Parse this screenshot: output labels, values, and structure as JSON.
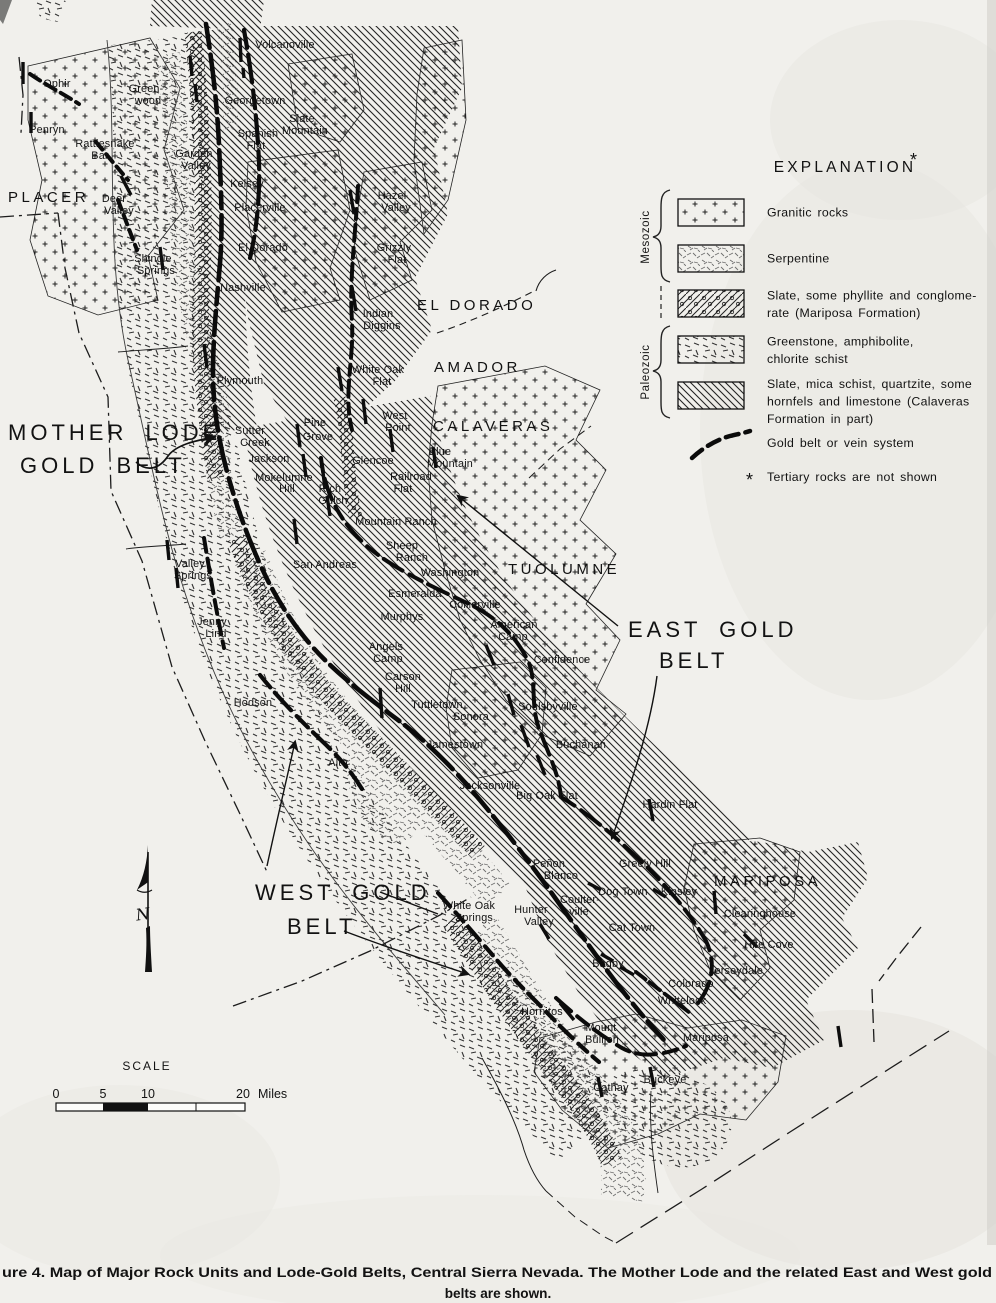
{
  "figure": {
    "caption_line1": "ure 4.  Map of Major Rock Units and Lode-Gold Belts, Central Sierra Nevada.  The Mother Lode and the related East and West gold",
    "caption_line2": "belts are shown."
  },
  "legend": {
    "title": "EXPLANATION",
    "asterisk": "*",
    "eras": [
      {
        "label": "Mesozoic"
      },
      {
        "label": "Paleozoic"
      }
    ],
    "items": [
      {
        "pattern": "granitic",
        "lines": [
          "Granitic rocks"
        ]
      },
      {
        "pattern": "serp",
        "lines": [
          "Serpentine"
        ]
      },
      {
        "pattern": "marip",
        "lines": [
          "Slate, some phyllite and conglome-",
          "rate (Mariposa Formation)"
        ]
      },
      {
        "pattern": "green",
        "lines": [
          "Greenstone, amphibolite,",
          "chlorite schist"
        ]
      },
      {
        "pattern": "cala",
        "lines": [
          "Slate, mica schist, quartzite, some",
          "hornfels and limestone (Calaveras",
          "Formation in part)"
        ]
      }
    ],
    "gold_line_label": "Gold belt or vein system",
    "footnote_marker": "*",
    "footnote": "Tertiary rocks are not shown"
  },
  "scale_bar": {
    "title": "SCALE",
    "tick_labels": [
      "0",
      "5",
      "10",
      "20"
    ],
    "unit": "Miles"
  },
  "compass": {
    "letter": "N"
  },
  "ink_color": "#141414",
  "paper_color": "#f1f0ec",
  "belt_annotations": [
    {
      "id": "mother-lode-gold-belt",
      "lines": [
        {
          "t": "MOTHER LODE",
          "x": 8,
          "y": 440
        },
        {
          "t": "GOLD BELT",
          "x": 20,
          "y": 473
        }
      ]
    },
    {
      "id": "east-gold-belt",
      "lines": [
        {
          "t": "EAST GOLD",
          "x": 628,
          "y": 637
        },
        {
          "t": "BELT",
          "x": 659,
          "y": 668
        }
      ]
    },
    {
      "id": "west-gold-belt",
      "lines": [
        {
          "t": "WEST GOLD",
          "x": 255,
          "y": 900
        },
        {
          "t": "BELT",
          "x": 287,
          "y": 934
        }
      ]
    }
  ],
  "counties": [
    {
      "t": "PLACER",
      "x": 8,
      "y": 202
    },
    {
      "t": "EL DORADO",
      "x": 417,
      "y": 310
    },
    {
      "t": "AMADOR",
      "x": 434,
      "y": 372
    },
    {
      "t": "CALAVERAS",
      "x": 433,
      "y": 431
    },
    {
      "t": "TUOLUMNE",
      "x": 508,
      "y": 574
    },
    {
      "t": "MARIPOSA",
      "x": 714,
      "y": 886
    }
  ],
  "towns": [
    {
      "t": "Volcanoville",
      "x": 285,
      "y": 48
    },
    {
      "t": "Ophir",
      "x": 57,
      "y": 87
    },
    {
      "t": "Penryn",
      "x": 47,
      "y": 133
    },
    {
      "t": "Green-",
      "x": 146,
      "y": 92
    },
    {
      "t": "wood",
      "x": 148,
      "y": 104
    },
    {
      "t": "Georgetown",
      "x": 255,
      "y": 104
    },
    {
      "t": "Slate",
      "x": 302,
      "y": 122
    },
    {
      "t": "Mountain",
      "x": 305,
      "y": 134
    },
    {
      "t": "Spanish",
      "x": 258,
      "y": 137
    },
    {
      "t": "Flat",
      "x": 256,
      "y": 149
    },
    {
      "t": "Rattlesnake",
      "x": 105,
      "y": 147
    },
    {
      "t": "Bar",
      "x": 100,
      "y": 159
    },
    {
      "t": "Garden",
      "x": 194,
      "y": 157
    },
    {
      "t": "Valley",
      "x": 196,
      "y": 169
    },
    {
      "t": "Kelsey",
      "x": 247,
      "y": 187
    },
    {
      "t": "Deer",
      "x": 114,
      "y": 202
    },
    {
      "t": "Valley",
      "x": 119,
      "y": 214
    },
    {
      "t": "Placerville",
      "x": 260,
      "y": 211
    },
    {
      "t": "El Dorado",
      "x": 263,
      "y": 251
    },
    {
      "t": "Shingle",
      "x": 153,
      "y": 262
    },
    {
      "t": "Springs",
      "x": 156,
      "y": 274
    },
    {
      "t": "Nashville",
      "x": 243,
      "y": 291
    },
    {
      "t": "Hazel",
      "x": 392,
      "y": 199
    },
    {
      "t": "Valley",
      "x": 396,
      "y": 211
    },
    {
      "t": "Grizzly",
      "x": 394,
      "y": 251
    },
    {
      "t": "Flat",
      "x": 397,
      "y": 263
    },
    {
      "t": "Indian",
      "x": 378,
      "y": 317
    },
    {
      "t": "Diggins",
      "x": 382,
      "y": 329
    },
    {
      "t": "White Oak",
      "x": 378,
      "y": 373
    },
    {
      "t": "Flat",
      "x": 382,
      "y": 385
    },
    {
      "t": "Plymouth",
      "x": 240,
      "y": 384
    },
    {
      "t": "Sutter",
      "x": 250,
      "y": 434
    },
    {
      "t": "Creek",
      "x": 255,
      "y": 446
    },
    {
      "t": "Pine",
      "x": 315,
      "y": 426
    },
    {
      "t": "Grove",
      "x": 318,
      "y": 440
    },
    {
      "t": "Jackson",
      "x": 269,
      "y": 462
    },
    {
      "t": "Mokelumne",
      "x": 284,
      "y": 481
    },
    {
      "t": "Hill",
      "x": 287,
      "y": 492
    },
    {
      "t": "Rich",
      "x": 330,
      "y": 492
    },
    {
      "t": "Gulch",
      "x": 333,
      "y": 504
    },
    {
      "t": "West",
      "x": 395,
      "y": 419
    },
    {
      "t": "Point",
      "x": 398,
      "y": 431
    },
    {
      "t": "Glencoe",
      "x": 373,
      "y": 464
    },
    {
      "t": "Blue",
      "x": 440,
      "y": 455
    },
    {
      "t": "Mountain",
      "x": 450,
      "y": 467
    },
    {
      "t": "Railroad",
      "x": 411,
      "y": 480
    },
    {
      "t": "Flat",
      "x": 403,
      "y": 492
    },
    {
      "t": "Mountain Ranch",
      "x": 396,
      "y": 525
    },
    {
      "t": "Sheep",
      "x": 402,
      "y": 549
    },
    {
      "t": "Ranch",
      "x": 412,
      "y": 561
    },
    {
      "t": "San Andreas",
      "x": 325,
      "y": 568
    },
    {
      "t": "Washington",
      "x": 450,
      "y": 576
    },
    {
      "t": "Esmeralda",
      "x": 415,
      "y": 597
    },
    {
      "t": "Collierville",
      "x": 475,
      "y": 608
    },
    {
      "t": "Murphys",
      "x": 402,
      "y": 620
    },
    {
      "t": "American",
      "x": 514,
      "y": 628
    },
    {
      "t": "Camp",
      "x": 513,
      "y": 640
    },
    {
      "t": "Angels",
      "x": 386,
      "y": 650
    },
    {
      "t": "Camp",
      "x": 388,
      "y": 662
    },
    {
      "t": "Carson",
      "x": 403,
      "y": 680
    },
    {
      "t": "Hill",
      "x": 403,
      "y": 692
    },
    {
      "t": "Confidence",
      "x": 562,
      "y": 663
    },
    {
      "t": "Valley",
      "x": 190,
      "y": 567
    },
    {
      "t": "Springs",
      "x": 193,
      "y": 579
    },
    {
      "t": "Jenny",
      "x": 212,
      "y": 625
    },
    {
      "t": "Lind",
      "x": 216,
      "y": 637
    },
    {
      "t": "Hodson",
      "x": 253,
      "y": 706
    },
    {
      "t": "Tuttletown",
      "x": 437,
      "y": 708
    },
    {
      "t": "Sonora",
      "x": 471,
      "y": 720
    },
    {
      "t": "Jamestown",
      "x": 455,
      "y": 748
    },
    {
      "t": "Alto",
      "x": 338,
      "y": 766
    },
    {
      "t": "Soulsbyville",
      "x": 548,
      "y": 710
    },
    {
      "t": "Buchanan",
      "x": 581,
      "y": 748
    },
    {
      "t": "Jacksonville",
      "x": 490,
      "y": 789
    },
    {
      "t": "Big Oak Flat",
      "x": 547,
      "y": 799
    },
    {
      "t": "Hardin Flat",
      "x": 670,
      "y": 808
    },
    {
      "t": "Peñon",
      "x": 549,
      "y": 867
    },
    {
      "t": "Blanco",
      "x": 561,
      "y": 879
    },
    {
      "t": "Greely Hill",
      "x": 645,
      "y": 867
    },
    {
      "t": "Dog Town",
      "x": 623,
      "y": 895
    },
    {
      "t": "Kinsley",
      "x": 679,
      "y": 895
    },
    {
      "t": "Coulter-",
      "x": 580,
      "y": 903
    },
    {
      "t": "ville",
      "x": 579,
      "y": 915
    },
    {
      "t": "White Oak",
      "x": 469,
      "y": 909
    },
    {
      "t": "Springs",
      "x": 474,
      "y": 921
    },
    {
      "t": "Hunter",
      "x": 531,
      "y": 913
    },
    {
      "t": "Valley",
      "x": 539,
      "y": 925
    },
    {
      "t": "Cat Town",
      "x": 632,
      "y": 931
    },
    {
      "t": "Clearinghouse",
      "x": 760,
      "y": 917
    },
    {
      "t": "Hite Cove",
      "x": 769,
      "y": 948
    },
    {
      "t": "Jerseydale",
      "x": 736,
      "y": 974
    },
    {
      "t": "Bagby",
      "x": 608,
      "y": 967
    },
    {
      "t": "Colorado",
      "x": 691,
      "y": 987
    },
    {
      "t": "Whitelock",
      "x": 682,
      "y": 1004
    },
    {
      "t": "Hornitos",
      "x": 542,
      "y": 1015
    },
    {
      "t": "Mount",
      "x": 601,
      "y": 1031
    },
    {
      "t": "Bullion",
      "x": 602,
      "y": 1043
    },
    {
      "t": "Mariposa",
      "x": 706,
      "y": 1041
    },
    {
      "t": "Cathay",
      "x": 611,
      "y": 1091
    },
    {
      "t": "Buckeye",
      "x": 665,
      "y": 1083
    }
  ]
}
